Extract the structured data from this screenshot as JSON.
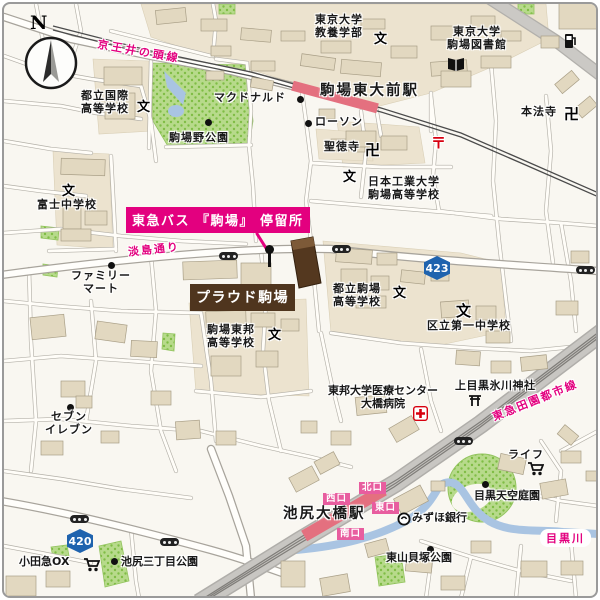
{
  "compass": {
    "north": "N"
  },
  "railways": {
    "keio": "京王井の頭線",
    "tokyu": "東急田園都市線"
  },
  "stations": {
    "komaba_todaimae": "駒場東大前駅",
    "ikejiri_ohashi": "池尻大橋駅",
    "exits": {
      "north": "北口",
      "west": "西口",
      "east": "東口",
      "south": "南口"
    }
  },
  "highlight": {
    "bus_stop_banner": "東急バス 『駒場』 停留所",
    "property_banner": "プラウド駒場"
  },
  "roads": {
    "awashima_dori": "淡島通り",
    "route_423": "423",
    "route_420": "420"
  },
  "schools": {
    "todai_kyoyo": "東京大学\n教養学部",
    "todai_library": "東京大学\n駒場図書館",
    "kokusai_high": "都立国際\n高等学校",
    "fuji_junior": "富士中学校",
    "nihon_kogyo": "日本工業大学\n駒場高等学校",
    "toritsu_komaba": "都立駒場\n高等学校",
    "komaba_toho": "駒場東邦\n高等学校",
    "kuritsu_daiichi": "区立第一中学校",
    "school_symbol": "文"
  },
  "temples": {
    "shotokuji": "聖徳寺",
    "honpoji": "本法寺",
    "manji": "卍"
  },
  "shrine": {
    "kamimeguro_hikawa": "上目黒氷川神社"
  },
  "hospital": {
    "name": "東邦大学医療センター\n大橋病院"
  },
  "parks": {
    "komabano": "駒場野公園",
    "ikejiri_sanchome": "池尻三丁目公園",
    "higashiyama_kaizuka": "東山貝塚公園",
    "meguro_tenku": "目黒天空庭園"
  },
  "river": {
    "megurogawa": "目黒川"
  },
  "pois": {
    "mcdonalds": "マクドナルド",
    "lawson": "ローソン",
    "familymart": "ファミリー\nマート",
    "seven_eleven": "セブン\nイレブン",
    "odakyu_ox": "小田急OX",
    "life": "ライフ",
    "mizuho": "みずほ銀行"
  },
  "post_symbol": "〒",
  "colors": {
    "route_accent": "#e3007f",
    "banner_brown": "#4f351e",
    "station_pink": "#e4707f",
    "park_green": "#b7da8b",
    "water_blue": "#a9c4e2",
    "route_badge_blue": "#1f63ae"
  }
}
